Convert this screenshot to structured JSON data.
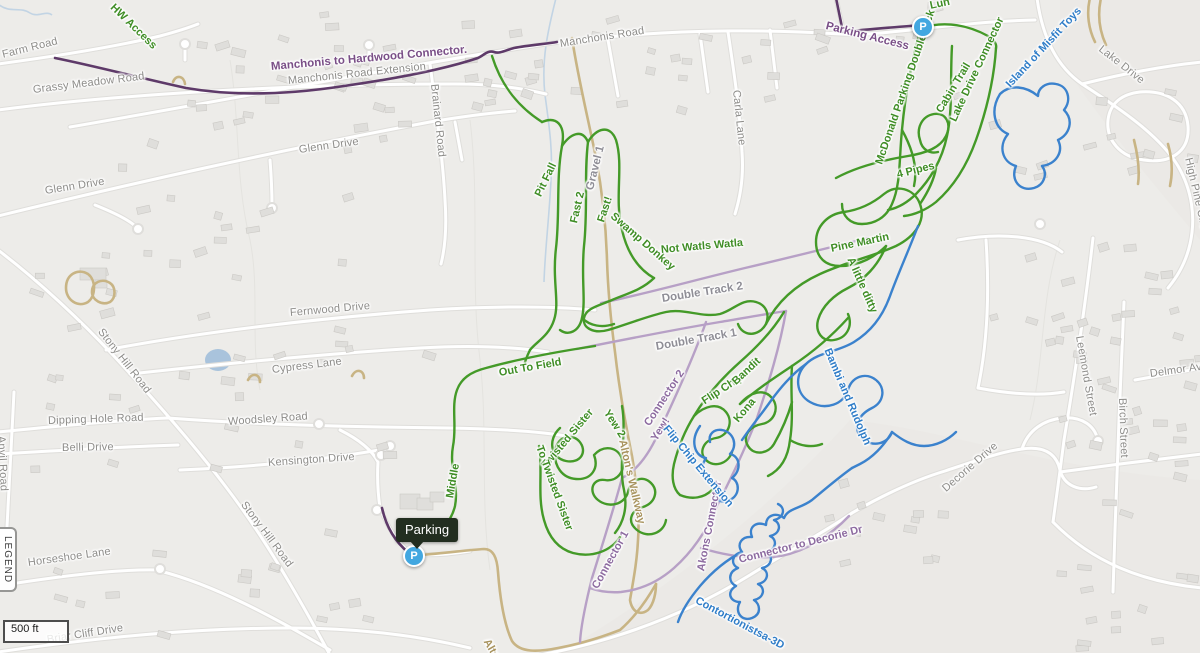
{
  "map": {
    "controls": {
      "legend_label": "LEGEND",
      "scale_label": "500 ft"
    },
    "markers": {
      "parking_tooltip_text": "Parking",
      "parking_marker_letter": "P",
      "parking_marker_letter_2": "P"
    },
    "colors": {
      "trail_green": "#449a28",
      "trail_blue": "#3b82cd",
      "trail_purple_dark": "#5e3a69",
      "trail_purple_light": "#b7a0c6",
      "path_tan": "#c8b484",
      "street_label_gray": "#8d8c89",
      "marker_blue": "#42a7e0",
      "tooltip_bg": "#222e20",
      "water_blue": "#a9c3dc"
    },
    "street_labels": [
      {
        "text": "Old Farm Road",
        "x": -18,
        "y": 60,
        "r": -14
      },
      {
        "text": "Grassy Meadow Road",
        "x": 33,
        "y": 90,
        "r": -7
      },
      {
        "text": "Manchonis Road Extension",
        "x": 288,
        "y": 81,
        "r": -6
      },
      {
        "text": "Manchonis Road",
        "x": 560,
        "y": 44,
        "r": -9
      },
      {
        "text": "Brainard Road",
        "x": 434,
        "y": 84,
        "r": 84
      },
      {
        "text": "Carla Lane",
        "x": 736,
        "y": 90,
        "r": 84
      },
      {
        "text": "Glenn Drive",
        "x": 45,
        "y": 191,
        "r": -9
      },
      {
        "text": "Glenn Drive",
        "x": 299,
        "y": 150,
        "r": -8
      },
      {
        "text": "Fernwood Drive",
        "x": 290,
        "y": 313,
        "r": -5
      },
      {
        "text": "Stony Hill Road",
        "x": 100,
        "y": 330,
        "r": 52
      },
      {
        "text": "Cypress Lane",
        "x": 272,
        "y": 370,
        "r": -7
      },
      {
        "text": "Dipping Hole Road",
        "x": 48,
        "y": 421,
        "r": -2
      },
      {
        "text": "Woodsley Road",
        "x": 228,
        "y": 422,
        "r": -4
      },
      {
        "text": "Belli Drive",
        "x": 62,
        "y": 448,
        "r": -1
      },
      {
        "text": "Kensington Drive",
        "x": 268,
        "y": 463,
        "r": -4
      },
      {
        "text": "Anvil Road",
        "x": 1,
        "y": 436,
        "r": 87
      },
      {
        "text": "Horseshoe Lane",
        "x": 28,
        "y": 563,
        "r": -8
      },
      {
        "text": "Stony Hill Road",
        "x": 243,
        "y": 503,
        "r": 53
      },
      {
        "text": "Briar Cliff Drive",
        "x": 47,
        "y": 640,
        "r": -9
      },
      {
        "text": "Lake Drive",
        "x": 1100,
        "y": 48,
        "r": 38
      },
      {
        "text": "High Pine Circ",
        "x": 1188,
        "y": 158,
        "r": 77
      },
      {
        "text": "Leemond Street",
        "x": 1079,
        "y": 336,
        "r": 80
      },
      {
        "text": "Birch Street",
        "x": 1122,
        "y": 398,
        "r": 88
      },
      {
        "text": "Delmor Av",
        "x": 1150,
        "y": 374,
        "r": -8
      },
      {
        "text": "Decorie Drive",
        "x": 944,
        "y": 490,
        "r": -41
      }
    ],
    "trail_labels": [
      {
        "text": "HW Access",
        "x": 112,
        "y": 6,
        "r": 44,
        "kind": "green"
      },
      {
        "text": "Lun",
        "x": 930,
        "y": 6,
        "r": -12,
        "kind": "green"
      },
      {
        "text": "Pit Fall",
        "x": 538,
        "y": 196,
        "r": -64,
        "kind": "green"
      },
      {
        "text": "Fast 2",
        "x": 574,
        "y": 223,
        "r": -77,
        "kind": "green"
      },
      {
        "text": "Gravel 1",
        "x": 590,
        "y": 190,
        "r": -76,
        "kind": "track"
      },
      {
        "text": "Fast!",
        "x": 601,
        "y": 222,
        "r": -72,
        "kind": "green"
      },
      {
        "text": "Swamp Donkey",
        "x": 612,
        "y": 215,
        "r": 41,
        "kind": "green"
      },
      {
        "text": "Not Watls Watla",
        "x": 661,
        "y": 250,
        "r": -5,
        "kind": "green"
      },
      {
        "text": "Double Track 2",
        "x": 662,
        "y": 299,
        "r": -9,
        "kind": "track"
      },
      {
        "text": "Double Track 1",
        "x": 656,
        "y": 347,
        "r": -10,
        "kind": "track"
      },
      {
        "text": "Pine Martin",
        "x": 831,
        "y": 249,
        "r": -12,
        "kind": "green"
      },
      {
        "text": "4 Pipes",
        "x": 897,
        "y": 175,
        "r": -14,
        "kind": "green"
      },
      {
        "text": "A little ditty",
        "x": 850,
        "y": 258,
        "r": 66,
        "kind": "green"
      },
      {
        "text": "McDonald Parking Doubletrack",
        "x": 879,
        "y": 164,
        "r": -71,
        "kind": "green"
      },
      {
        "text": "Cabin Trail",
        "x": 939,
        "y": 112,
        "r": -59,
        "kind": "green"
      },
      {
        "text": "Lake Drive Connector",
        "x": 953,
        "y": 121,
        "r": -65,
        "kind": "green"
      },
      {
        "text": "Island of Misfit Toys",
        "x": 1008,
        "y": 86,
        "r": -47,
        "kind": "blue"
      },
      {
        "text": "Parking Access",
        "x": 826,
        "y": 26,
        "r": 14,
        "kind": "purple"
      },
      {
        "text": "Manchonis to Hardwood Connector.",
        "x": 271,
        "y": 67,
        "r": -5,
        "kind": "purple"
      },
      {
        "text": "Out To Field",
        "x": 499,
        "y": 373,
        "r": -10,
        "kind": "green"
      },
      {
        "text": "Twisted Sister",
        "x": 544,
        "y": 467,
        "r": -50,
        "kind": "green"
      },
      {
        "text": "To Twisted Sister",
        "x": 539,
        "y": 446,
        "r": 70,
        "kind": "green"
      },
      {
        "text": "Yew 2",
        "x": 606,
        "y": 411,
        "r": 57,
        "kind": "green"
      },
      {
        "text": "Alton's Walkway",
        "x": 622,
        "y": 440,
        "r": 77,
        "kind": "tan"
      },
      {
        "text": "Alto",
        "x": 486,
        "y": 640,
        "r": 60,
        "kind": "tan"
      },
      {
        "text": "Yew!",
        "x": 654,
        "y": 440,
        "r": -58,
        "kind": "connector"
      },
      {
        "text": "Connector 2",
        "x": 647,
        "y": 425,
        "r": -57,
        "kind": "connector"
      },
      {
        "text": "Connector 1",
        "x": 595,
        "y": 588,
        "r": -61,
        "kind": "connector"
      },
      {
        "text": "Akons Connector",
        "x": 701,
        "y": 571,
        "r": -79,
        "kind": "connector"
      },
      {
        "text": "Connector to Decorie Dr",
        "x": 739,
        "y": 560,
        "r": -14,
        "kind": "connector"
      },
      {
        "text": "Middle",
        "x": 450,
        "y": 498,
        "r": -80,
        "kind": "green"
      },
      {
        "text": "Flip Chip",
        "x": 703,
        "y": 402,
        "r": -33,
        "kind": "green"
      },
      {
        "text": "Kona",
        "x": 736,
        "y": 421,
        "r": -50,
        "kind": "green"
      },
      {
        "text": "Bandit",
        "x": 734,
        "y": 383,
        "r": -43,
        "kind": "green"
      },
      {
        "text": "Flip Chip Extension",
        "x": 665,
        "y": 427,
        "r": 50,
        "kind": "blue"
      },
      {
        "text": "Bambi and Rudolph",
        "x": 827,
        "y": 349,
        "r": 67,
        "kind": "blue"
      },
      {
        "text": "Contortionistsa-3D",
        "x": 696,
        "y": 600,
        "r": 28,
        "kind": "blue"
      }
    ]
  }
}
